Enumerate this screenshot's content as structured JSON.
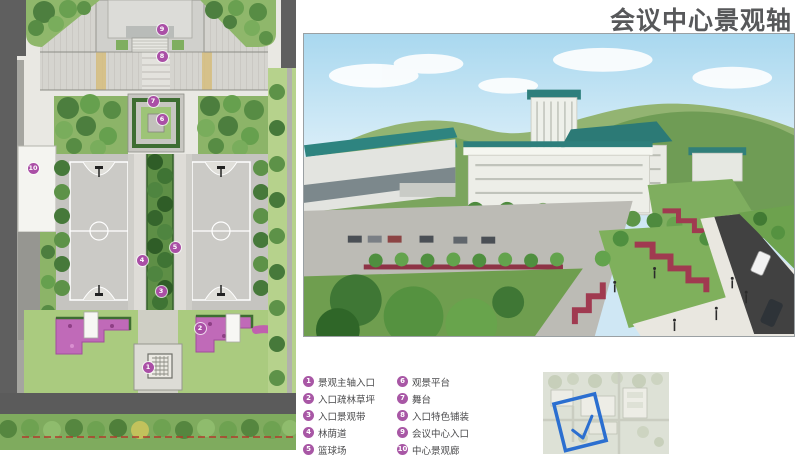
{
  "page": {
    "title": "会议中心景观轴"
  },
  "legend": {
    "items": [
      {
        "num": "1",
        "label": "景观主轴入口"
      },
      {
        "num": "2",
        "label": "入口疏林草坪"
      },
      {
        "num": "3",
        "label": "入口景观带"
      },
      {
        "num": "4",
        "label": "林荫道"
      },
      {
        "num": "5",
        "label": "篮球场"
      },
      {
        "num": "6",
        "label": "观景平台"
      },
      {
        "num": "7",
        "label": "舞台"
      },
      {
        "num": "8",
        "label": "入口特色铺装"
      },
      {
        "num": "9",
        "label": "会议中心入口"
      },
      {
        "num": "10",
        "label": "中心景观廊"
      }
    ]
  },
  "plan": {
    "markers": [
      {
        "num": "1"
      },
      {
        "num": "2"
      },
      {
        "num": "3"
      },
      {
        "num": "4"
      },
      {
        "num": "5"
      },
      {
        "num": "6"
      },
      {
        "num": "7"
      },
      {
        "num": "8"
      },
      {
        "num": "9"
      },
      {
        "num": "10"
      }
    ]
  },
  "colors": {
    "title_text": "#57585a",
    "legend_badge": "#a857a5",
    "marker_purple": "#aa4fa6",
    "sketch_blue": "#2b6fd0",
    "flower_magenta": "#c06ab8",
    "flower_red": "#a03a50",
    "roof_teal": "#2e8480",
    "lawn_green": "#8cb468",
    "road_gray": "#5f5f5f"
  }
}
